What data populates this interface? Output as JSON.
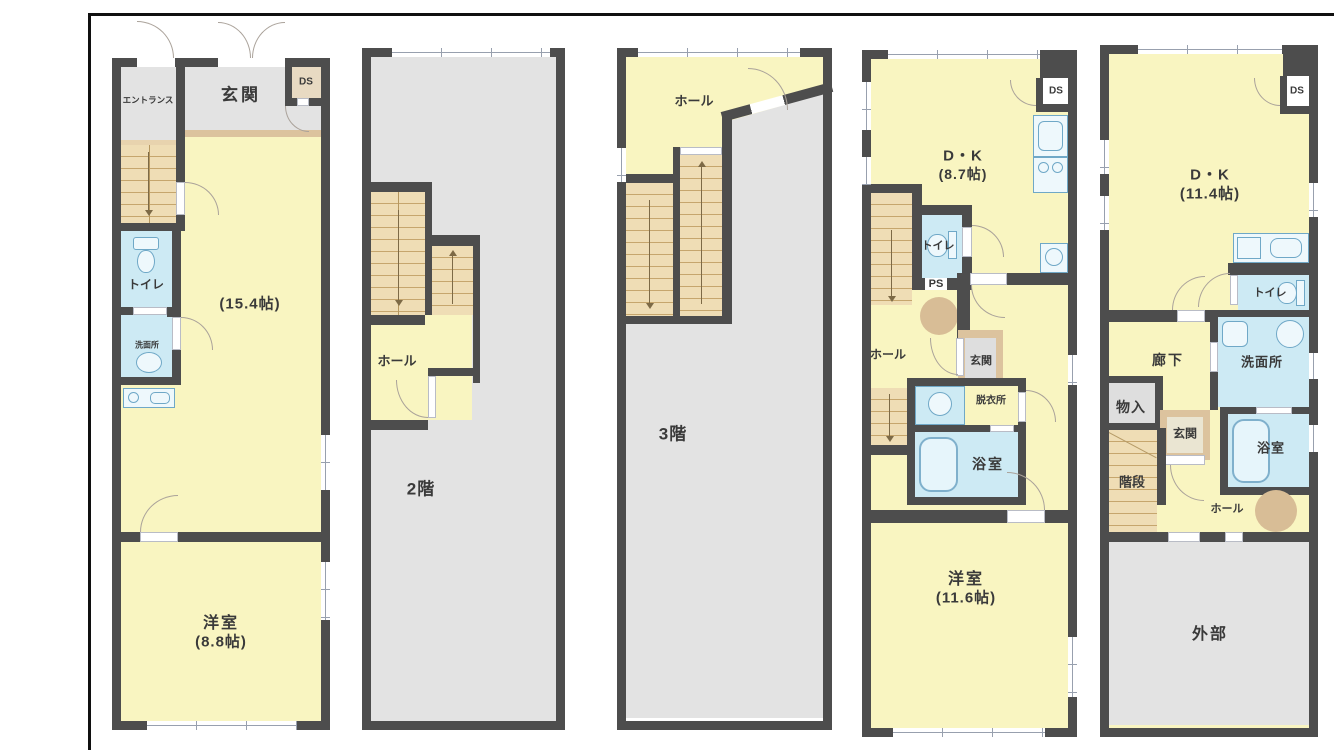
{
  "colors": {
    "wall": "#4d4d4d",
    "room_yellow": "#f9f5c1",
    "room_gray": "#e3e3e3",
    "wet_blue": "#cdeaf4",
    "stairs_tan": "#efddb5",
    "trim_beige": "#dcc39e",
    "column_tan": "#d8bd96",
    "frame_line": "#101010"
  },
  "panels": [
    {
      "name": "floor-1",
      "labels": {
        "entrance_lobby": "エントランス",
        "genkan": "玄関",
        "ds": "DS",
        "toilet": "トイレ",
        "washroom": "洗面所",
        "living_size": "(15.4帖)",
        "room": "洋室",
        "room_size": "(8.8帖)"
      }
    },
    {
      "name": "floor-2",
      "labels": {
        "hall": "ホール",
        "floor": "2階"
      }
    },
    {
      "name": "floor-3",
      "labels": {
        "hall": "ホール",
        "floor": "3階"
      }
    },
    {
      "name": "floor-4",
      "labels": {
        "dk": "D・K",
        "dk_size": "(8.7帖)",
        "ds": "DS",
        "toilet": "トイレ",
        "ps": "PS",
        "hall": "ホール",
        "genkan": "玄関",
        "dressing": "脱衣所",
        "bath": "浴室",
        "room": "洋室",
        "room_size": "(11.6帖)"
      }
    },
    {
      "name": "floor-5",
      "labels": {
        "dk": "D・K",
        "dk_size": "(11.4帖)",
        "ds": "DS",
        "toilet": "トイレ",
        "corridor": "廊下",
        "washroom": "洗面所",
        "storage": "物入",
        "genkan": "玄関",
        "bath": "浴室",
        "stairs": "階段",
        "hall": "ホール",
        "exterior": "外部"
      }
    }
  ]
}
